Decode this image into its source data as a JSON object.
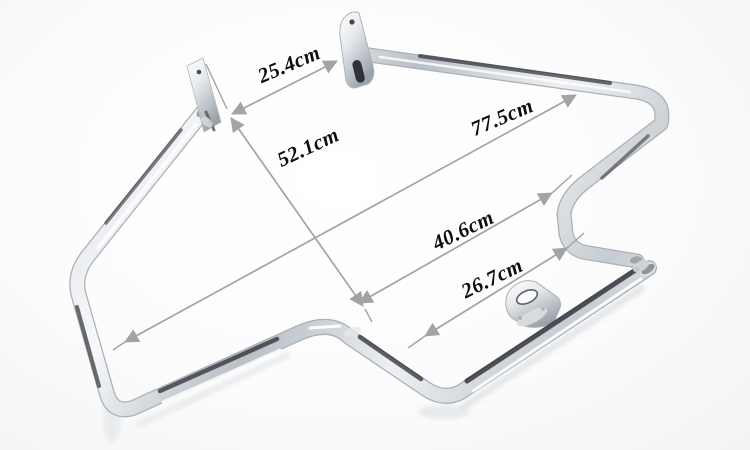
{
  "image": {
    "kind": "annotated product photo",
    "subject": "chrome motorcycle engine guard crash bar with three mounting tabs",
    "background_color": "#fbfbfc"
  },
  "palette": {
    "annotation_text": "#0d0d0d",
    "arrow_gray": "#a2a3a4",
    "chrome_light": "#f6f8fa",
    "chrome_mid": "#c3c9cf",
    "chrome_dark": "#7d848c",
    "chrome_streak": "#2b2e33"
  },
  "annotations": {
    "unit": "cm",
    "dimensions": [
      {
        "label": "25.4cm"
      },
      {
        "label": "52.1cm"
      },
      {
        "label": "77.5cm"
      },
      {
        "label": "40.6cm"
      },
      {
        "label": "26.7cm"
      }
    ]
  }
}
